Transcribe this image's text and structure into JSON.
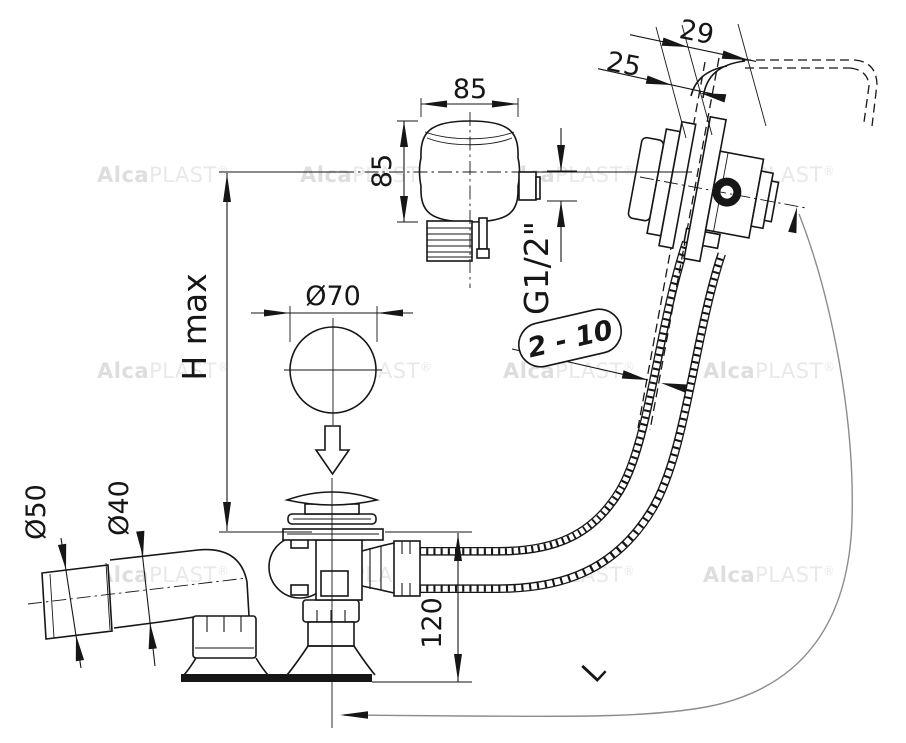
{
  "drawing": {
    "type": "technical-dimension-drawing",
    "subject": "bathtub waste, overflow set with flexible corrugated hose",
    "colors": {
      "line": "#161616",
      "background": "#ffffff",
      "guide": "#8c8c8c",
      "watermark": "#e4e4e4"
    },
    "watermark": {
      "bold": "Alca",
      "light": "PLAST",
      "registered": "®"
    },
    "dims": {
      "front_width": "85",
      "front_height": "85",
      "thread": "G1/2\"",
      "plug_diameter": "Ø70",
      "height_max": "H max",
      "outlet_outer": "Ø50",
      "outlet_inner": "Ø40",
      "install_height": "120",
      "overflow_depth": "29",
      "overflow_recess": "25",
      "wall_thickness_range": "2 - 10",
      "hose_length": "L"
    }
  }
}
